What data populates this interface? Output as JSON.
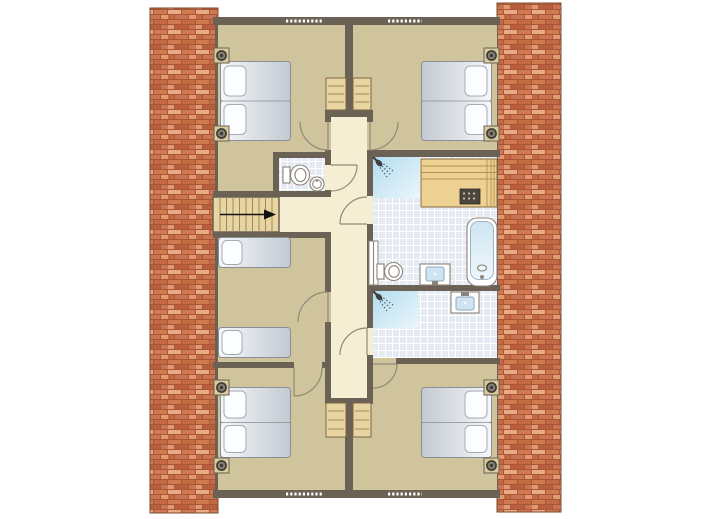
{
  "plan": {
    "type": "floor-plan",
    "view": "top-down upper floor of a holiday house between two brick walls",
    "exterior": {
      "brick_columns": 2,
      "windows_dashed_on_walls": 4
    },
    "hallway": {
      "shape": "vertical corridor with side landing",
      "door_openings": 8,
      "stairs": {
        "treads": 9,
        "direction_arrow": "right"
      },
      "wardrobes_top": 2,
      "wardrobes_bottom": 2
    },
    "rooms": [
      {
        "name": "bedroom-top-left",
        "beds": {
          "type": "double",
          "mattresses": 2,
          "pillows": 2
        },
        "wall_spots": 2,
        "window": true
      },
      {
        "name": "bedroom-top-right",
        "beds": {
          "type": "double",
          "mattresses": 2,
          "pillows": 2
        },
        "wall_spots": 2,
        "window": true
      },
      {
        "name": "wc",
        "fixtures": [
          "toilet",
          "round-washbasin"
        ],
        "floor": "tiles"
      },
      {
        "name": "bathroom",
        "fixtures": [
          "shower",
          "sauna-bench-with-heater",
          "bathtub",
          "toilet",
          "washbasin",
          "radiator"
        ],
        "floor": "tiles"
      },
      {
        "name": "shower-room",
        "fixtures": [
          "shower",
          "washbasin"
        ],
        "floor": "tiles"
      },
      {
        "name": "bedroom-middle-left",
        "beds": {
          "type": "single",
          "count": 2
        },
        "window": false
      },
      {
        "name": "bedroom-bottom-left",
        "beds": {
          "type": "double",
          "mattresses": 2,
          "pillows": 2
        },
        "wall_spots": 2,
        "window": true
      },
      {
        "name": "bedroom-bottom-right",
        "beds": {
          "type": "double",
          "mattresses": 2,
          "pillows": 2
        },
        "wall_spots": 2,
        "window": true
      }
    ]
  },
  "palette": {
    "wall": "#6b6255",
    "floor_tan": "#d0c49c",
    "floor_cream": "#f6eed2",
    "tile_bg": "#e6eaf3",
    "tile_line": "#ffffff",
    "wood": "#e9d5a1",
    "wood_grain": "#9b8a60",
    "wood_border": "#7b6843",
    "sauna_wood": "#ecd193",
    "sauna_line": "#b98f4e",
    "sauna_border": "#8a6b3f",
    "heater_dark": "#4c473d",
    "brick_1": "#d07a50",
    "brick_2": "#c36a42",
    "brick_3": "#e09a70",
    "brick_4": "#b95f3c",
    "brick_5": "#e8ab85",
    "brick_6": "#c97551",
    "brick_mortar": "#a8553a",
    "brick_border": "#7a4a30",
    "mattress_light": "#f5f7f9",
    "mattress_dark": "#c3cad3",
    "mattress_stroke": "#8a8e96",
    "pillow_fill": "#fcfdfe",
    "pillow_stroke": "#a5abb3",
    "shower_from": "#b3dcef",
    "shower_to": "#ebf6fb",
    "tub_from": "#cfe6f2",
    "tub_to": "#eef7fb",
    "basin_blue": "#cfe4f1",
    "basin_stroke": "#8fa8bc",
    "fixture_fill": "#ffffff",
    "fixture_stroke": "#8b8478",
    "door_arc": "#92897a",
    "spot_ring": "#3e3a32",
    "spot_base": "#d9cba0",
    "spot_center": "#857f72",
    "arrow_black": "#111111",
    "window_dash": "#ffffff"
  }
}
